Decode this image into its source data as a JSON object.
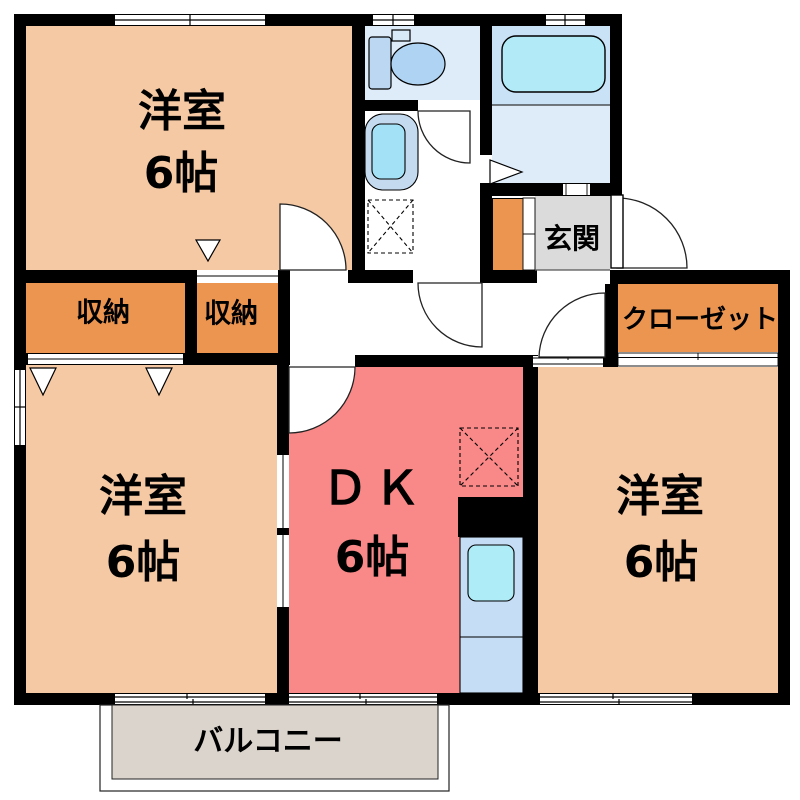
{
  "floorplan": {
    "rooms": [
      {
        "id": "bedroom-northwest",
        "label": "洋室",
        "size": "6帖"
      },
      {
        "id": "bedroom-southwest",
        "label": "洋室",
        "size": "6帖"
      },
      {
        "id": "dining-kitchen",
        "label": "ＤＫ",
        "size": "6帖"
      },
      {
        "id": "bedroom-southeast",
        "label": "洋室",
        "size": "6帖"
      }
    ],
    "storages": [
      {
        "label": "収納"
      },
      {
        "label": "収納"
      }
    ],
    "closet": {
      "label": "クローゼット"
    },
    "entrance": {
      "label": "玄関"
    },
    "balcony": {
      "label": "バルコニー"
    },
    "fixtures": [
      "toilet-icon",
      "washbasin-icon",
      "bathtub-icon",
      "kitchen-sink-icon",
      "washing-machine-pan-icon",
      "refrigerator-space-icon",
      "door-swing-arc-icon",
      "folding-door-triangle-icon",
      "sliding-window-icon"
    ],
    "colors": {
      "wall": "#000000",
      "bedroom_fill": "#F5C9A4",
      "storage_fill": "#EB9551",
      "dk_fill": "#F98888",
      "entrance_fill": "#DBDBDB",
      "balcony_fill": "#DBD4CD",
      "bath_wet_fill": "#C9E2F6",
      "sanitary_fill": "#DEEBF8",
      "fixture_blue": "#AFD3F2",
      "tub_fill": "#B2EAF8",
      "kitchen_unit_fill": "#C6DDF6",
      "sink_fill": "#AEEDF8"
    }
  }
}
